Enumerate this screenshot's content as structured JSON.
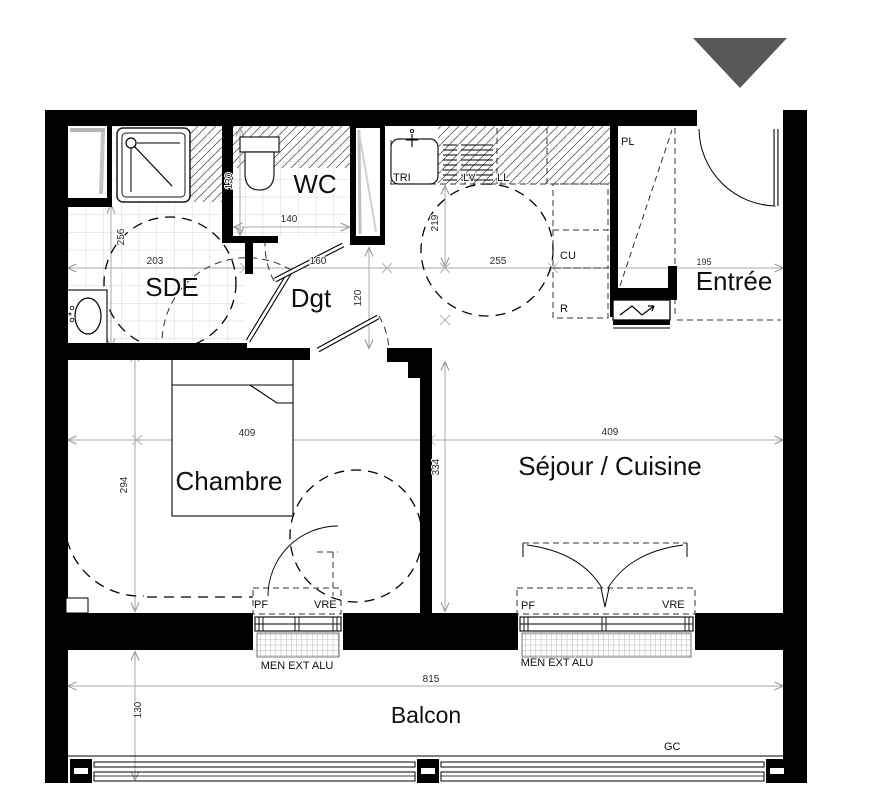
{
  "north_arrow": {
    "icon": "triangle-down",
    "color": "#58585B"
  },
  "rooms": {
    "sde": "SDE",
    "wc": "WC",
    "dgt": "Dgt",
    "entree": "Entrée",
    "chambre": "Chambre",
    "sejour_cuisine": "Séjour / Cuisine",
    "balcon": "Balcon"
  },
  "fixtures": {
    "pl": "PL",
    "tri": "TRI",
    "lv": "LV",
    "ll": "LL",
    "cu": "CU",
    "r": "R",
    "gc": "GC"
  },
  "windows": {
    "pf": "PF",
    "vre": "VRE",
    "men_ext_alu": "MEN EXT ALU"
  },
  "dimensions": {
    "sde_width": "203",
    "sde_depth": "256",
    "wc_depth": "130",
    "wc_width": "140",
    "dgt_width": "160",
    "dgt_depth": "120",
    "kitchen_depth": "219",
    "kitchen_width": "255",
    "entree_width": "195",
    "chambre_width": "409",
    "chambre_depth": "294",
    "sejour_width": "409",
    "sejour_depth": "334",
    "balcon_width": "815",
    "balcon_depth": "130"
  },
  "colors": {
    "wall": "#000000",
    "north_arrow": "#58585B",
    "dim_line": "#a8a8a8",
    "tile_grid": "#d6d6d6"
  }
}
